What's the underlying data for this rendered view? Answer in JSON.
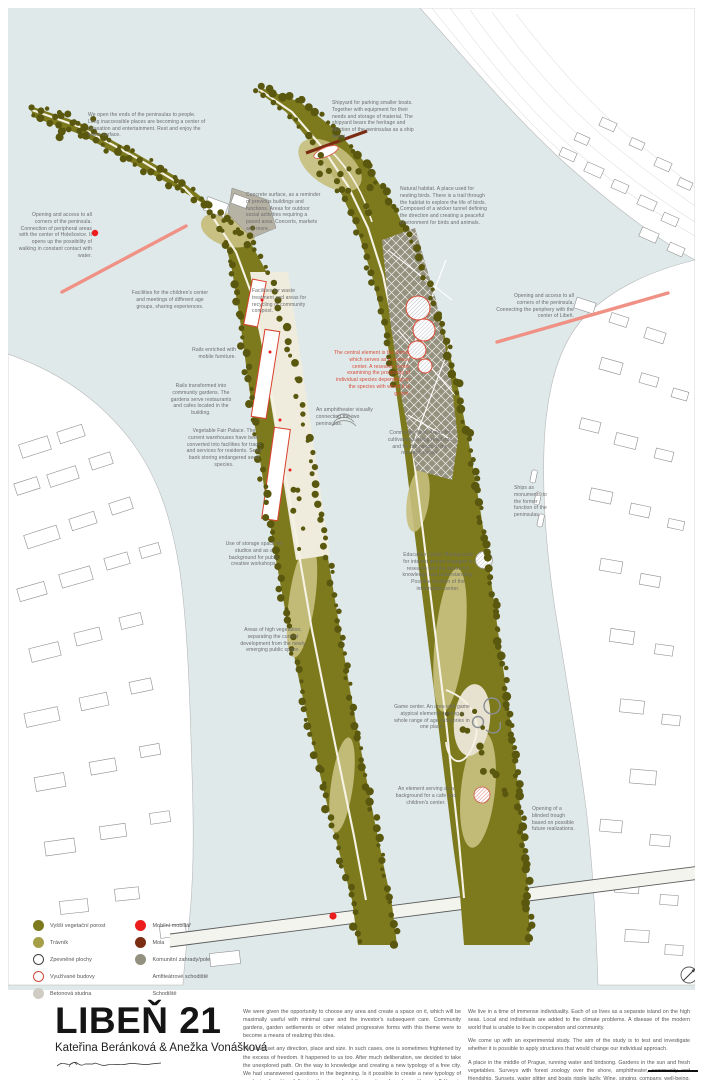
{
  "poster": {
    "title": "LIBEŇ 21",
    "authors": "Kateřina Beránková & Anežka Vonášková"
  },
  "colors": {
    "water": "#dfe9ea",
    "vegetation_high": "#7d7a1e",
    "lawn": "#c6bf7d",
    "tree": "#5a570f",
    "concrete": "#b6b2a4",
    "fields_gray": "#95917f",
    "accent_red": "#d84a35",
    "bright_red": "#ec1c1c",
    "pier_maroon": "#7b2d14",
    "pink_path": "#f09186",
    "cream_path": "#f6f3e6"
  },
  "legend": {
    "left": [
      {
        "swatch": "dot",
        "color": "#7d7a1e",
        "label": "Vyšší vegetační porost"
      },
      {
        "swatch": "dot",
        "color": "#a5a047",
        "label": "Trávník"
      },
      {
        "swatch": "ring",
        "color": "#444444",
        "label": "Zpevněné plochy"
      },
      {
        "swatch": "ring",
        "color": "#d04a3a",
        "label": "Využívané budovy"
      },
      {
        "swatch": "dot",
        "color": "#cfccc3",
        "label": "Betonová studna"
      }
    ],
    "right": [
      {
        "swatch": "dot",
        "color": "#ec1c1c",
        "label": "Mobilní mobiliář"
      },
      {
        "swatch": "dot",
        "color": "#7b2d14",
        "label": "Mola"
      },
      {
        "swatch": "dot",
        "color": "#93907f",
        "label": "Komunitní zahrady/pole"
      },
      {
        "swatch": "hatch",
        "color": "#b0aca0",
        "label": "Amfiteátrové schodiště"
      },
      {
        "swatch": "hatch",
        "color": "#d9604c",
        "label": "Schodiště"
      }
    ]
  },
  "map": {
    "annotations": [
      {
        "n": "open-ends",
        "t": "We open the ends of the peninsulas to people. Long inaccessible places are becoming a center of relaxation and entertainment. Rest and enjoy the water surface.",
        "x": 88,
        "y": 112,
        "w": 118,
        "a": "left"
      },
      {
        "n": "shipyard",
        "t": "Shipyard for parking smaller boats. Together with equipment for their needs and storage of material. The shipyard bears the heritage and function of the peninsulas as a ship depot.",
        "x": 332,
        "y": 100,
        "w": 82,
        "a": "left"
      },
      {
        "n": "opening-holesovice",
        "t": "Opening and access to all corners of the peninsula. Connection of peripheral areas with the center of Holešovice. It opens up the possibility of walking in constant contact with water.",
        "x": 18,
        "y": 212,
        "w": 74,
        "a": "right"
      },
      {
        "n": "concrete-surface",
        "t": "Concrete surface, as a reminder of previous buildings and functions. Areas for outdoor social activities requiring a paved area. Concerts, markets and more.",
        "x": 246,
        "y": 192,
        "w": 76,
        "a": "left"
      },
      {
        "n": "natural-habitat",
        "t": "Natural habitat. A place used for nesting birds. There is a trail through the habitat to explore the life of birds. Composed of a wicker tunnel defining the direction and creating a peaceful environment for birds and animals.",
        "x": 400,
        "y": 186,
        "w": 92,
        "a": "left"
      },
      {
        "n": "opening-liben",
        "t": "Opening and access to all corners of the peninsula. Connecting the periphery with the center of Libeň.",
        "x": 496,
        "y": 293,
        "w": 78,
        "a": "right"
      },
      {
        "n": "children-center",
        "t": "Facilities for the children's center and meetings of different age groups, sharing experiences.",
        "x": 128,
        "y": 290,
        "w": 84,
        "a": "center"
      },
      {
        "n": "waste-treatment",
        "t": "Facilities for waste treatment and areas for recycling or community compost.",
        "x": 252,
        "y": 288,
        "w": 64,
        "a": "left"
      },
      {
        "n": "rails-furniture",
        "t": "Rails enriched with mobile furniture.",
        "x": 178,
        "y": 347,
        "w": 58,
        "a": "right"
      },
      {
        "n": "rails-gardens",
        "t": "Rails transformed into community gardens. The gardens serve restaurants and cafes located in the building.",
        "x": 168,
        "y": 383,
        "w": 66,
        "a": "center"
      },
      {
        "n": "dome-science-center",
        "t": "The central element is the dome, which serves as a science center. A research center examining the prosperity of individual species depending on the species with which it is grown.",
        "x": 334,
        "y": 350,
        "w": 76,
        "a": "right",
        "c": "#d84a35"
      },
      {
        "n": "fair-palace",
        "t": "Vegetable Fair Palace. The current warehouses have been converted into facilities for trade and services for residents. Seed bank storing endangered seed species.",
        "x": 186,
        "y": 428,
        "w": 76,
        "a": "center"
      },
      {
        "n": "amphitheater",
        "t": "An amphitheater visually connecting the two peninsulas.",
        "x": 316,
        "y": 407,
        "w": 58,
        "a": "left"
      },
      {
        "n": "community-fields",
        "t": "Community field. Areas for cultivation serving residents and for the needs of the research center.",
        "x": 386,
        "y": 430,
        "w": 68,
        "a": "center"
      },
      {
        "n": "ships-monuments",
        "t": "Ships as monuments to the former function of the peninsulas.",
        "x": 514,
        "y": 485,
        "w": 40,
        "a": "left"
      },
      {
        "n": "storage-studios",
        "t": "Use of storage space for studios and as a background for public creative workshops.",
        "x": 222,
        "y": 541,
        "w": 64,
        "a": "center"
      },
      {
        "n": "education-center",
        "t": "Education center. Background for interest groups engaged in research and the desire for knowledge and understanding. Possible location of the information center.",
        "x": 400,
        "y": 552,
        "w": 76,
        "a": "center"
      },
      {
        "n": "high-vegetation",
        "t": "Areas of high vegetation, separating the current development from the newly emerging public space.",
        "x": 240,
        "y": 627,
        "w": 66,
        "a": "center"
      },
      {
        "n": "game-center",
        "t": "Game center. An area with game atypical elements serving a whole range of age categories in one place.",
        "x": 394,
        "y": 704,
        "w": 76,
        "a": "center"
      },
      {
        "n": "cafe-element",
        "t": "An element serving as a background for a cafe and children's center.",
        "x": 394,
        "y": 786,
        "w": 64,
        "a": "center"
      },
      {
        "n": "blinded-trough",
        "t": "Opening of a blinded trough based on possible future realizations.",
        "x": 532,
        "y": 806,
        "w": 46,
        "a": "left"
      }
    ]
  },
  "footer": {
    "col1": [
      "We were given the opportunity to choose any area and create a space on it, which will be maximally useful with minimal care and the investor's subsequent care. Community gardens, garden settlements or other related progressive forms with this theme were to become a means of realizing this idea.",
      "We could set any direction, place and size. In such cases, one is sometimes frightened by the excess of freedom. It happened to us too. After much deliberation, we decided to take the unexplored path. On the way to knowledge and creating a new typology of a free city. We had unanswered questions in the beginning. Is it possible to create a new typology of gardening for cities, following the example of the creation of garden settlements? How to enrich the townspeople with landscape structures that will offer them experiences connected mainly with the countryside and nature? What new functions must cities acquire in order to be attractive even at a time when their functions cannot be used?"
    ],
    "col2": [
      "We live in a time of immense individuality. Each of us lives as a separate island on the high seas. Local and individuals are added to the climate problems. A disease of the modern world that is unable to live in cooperation and community.",
      "We come up with an experimental study. The aim of the study is to test and investigate whether it is possible to apply structures that would change our individual approach.",
      "A place in the middle of Prague, running water and birdsong. Gardens in the sun and fresh vegetables. Surveys with forest zoology over the shore, amphitheater, community and friendship. Sunsets, water glitter and boats ripple lazily. Wine, singing, company, well-being. A community that depends on its surroundings."
    ]
  }
}
